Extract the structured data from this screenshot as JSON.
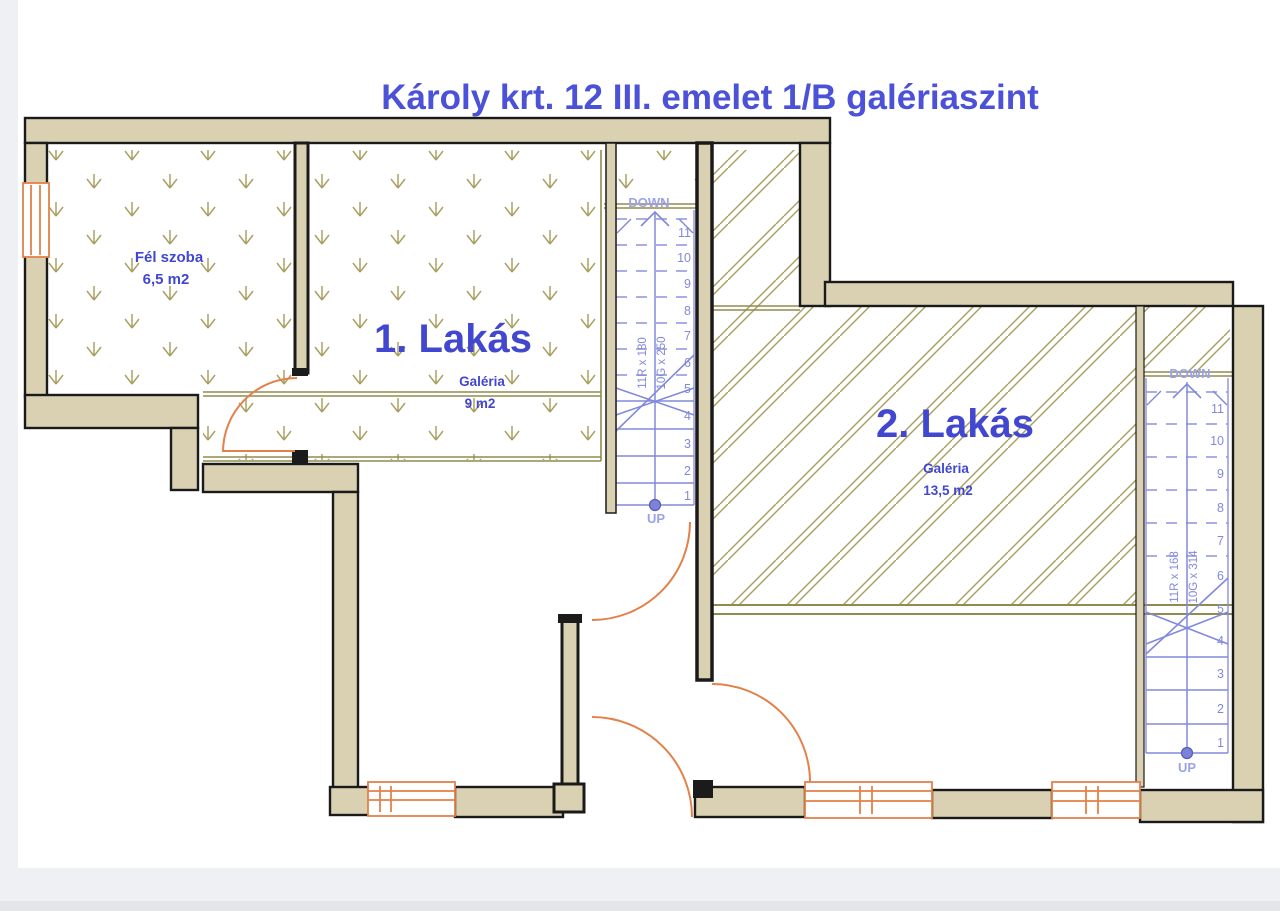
{
  "title": "Károly krt. 12 III. emelet 1/B galériaszint",
  "rooms": {
    "fel_szoba": {
      "name": "Fél szoba",
      "area": "6,5 m2"
    },
    "lakas1": {
      "name": "1. Lakás",
      "gallery": "Galéria",
      "area": "9 m2"
    },
    "lakas2": {
      "name": "2. Lakás",
      "gallery": "Galéria",
      "area": "13,5 m2"
    }
  },
  "stairs": {
    "left": {
      "down": "DOWN",
      "up": "UP",
      "riser_spec": "11R x 180",
      "going_spec": "10G x 250",
      "steps": [
        "1",
        "2",
        "3",
        "4",
        "5",
        "6",
        "7",
        "8",
        "9",
        "10",
        "11"
      ]
    },
    "right": {
      "down": "DOWN",
      "up": "UP",
      "riser_spec": "11R x 168",
      "going_spec": "10G x 314",
      "steps": [
        "1",
        "2",
        "3",
        "4",
        "5",
        "6",
        "7",
        "8",
        "9",
        "10",
        "11"
      ]
    }
  },
  "colors": {
    "wall": "#d9d1b2",
    "outline": "#1a1a1a",
    "hatch": "#a9a163",
    "gallery_line": "#918b4d",
    "stair": "#8289dc",
    "stair_faded": "#9ca2e8",
    "door_window": "#e2814a",
    "label": "#4147cf",
    "title": "#4c52d8",
    "paper": "#ffffff",
    "background": "#eef0f3"
  }
}
